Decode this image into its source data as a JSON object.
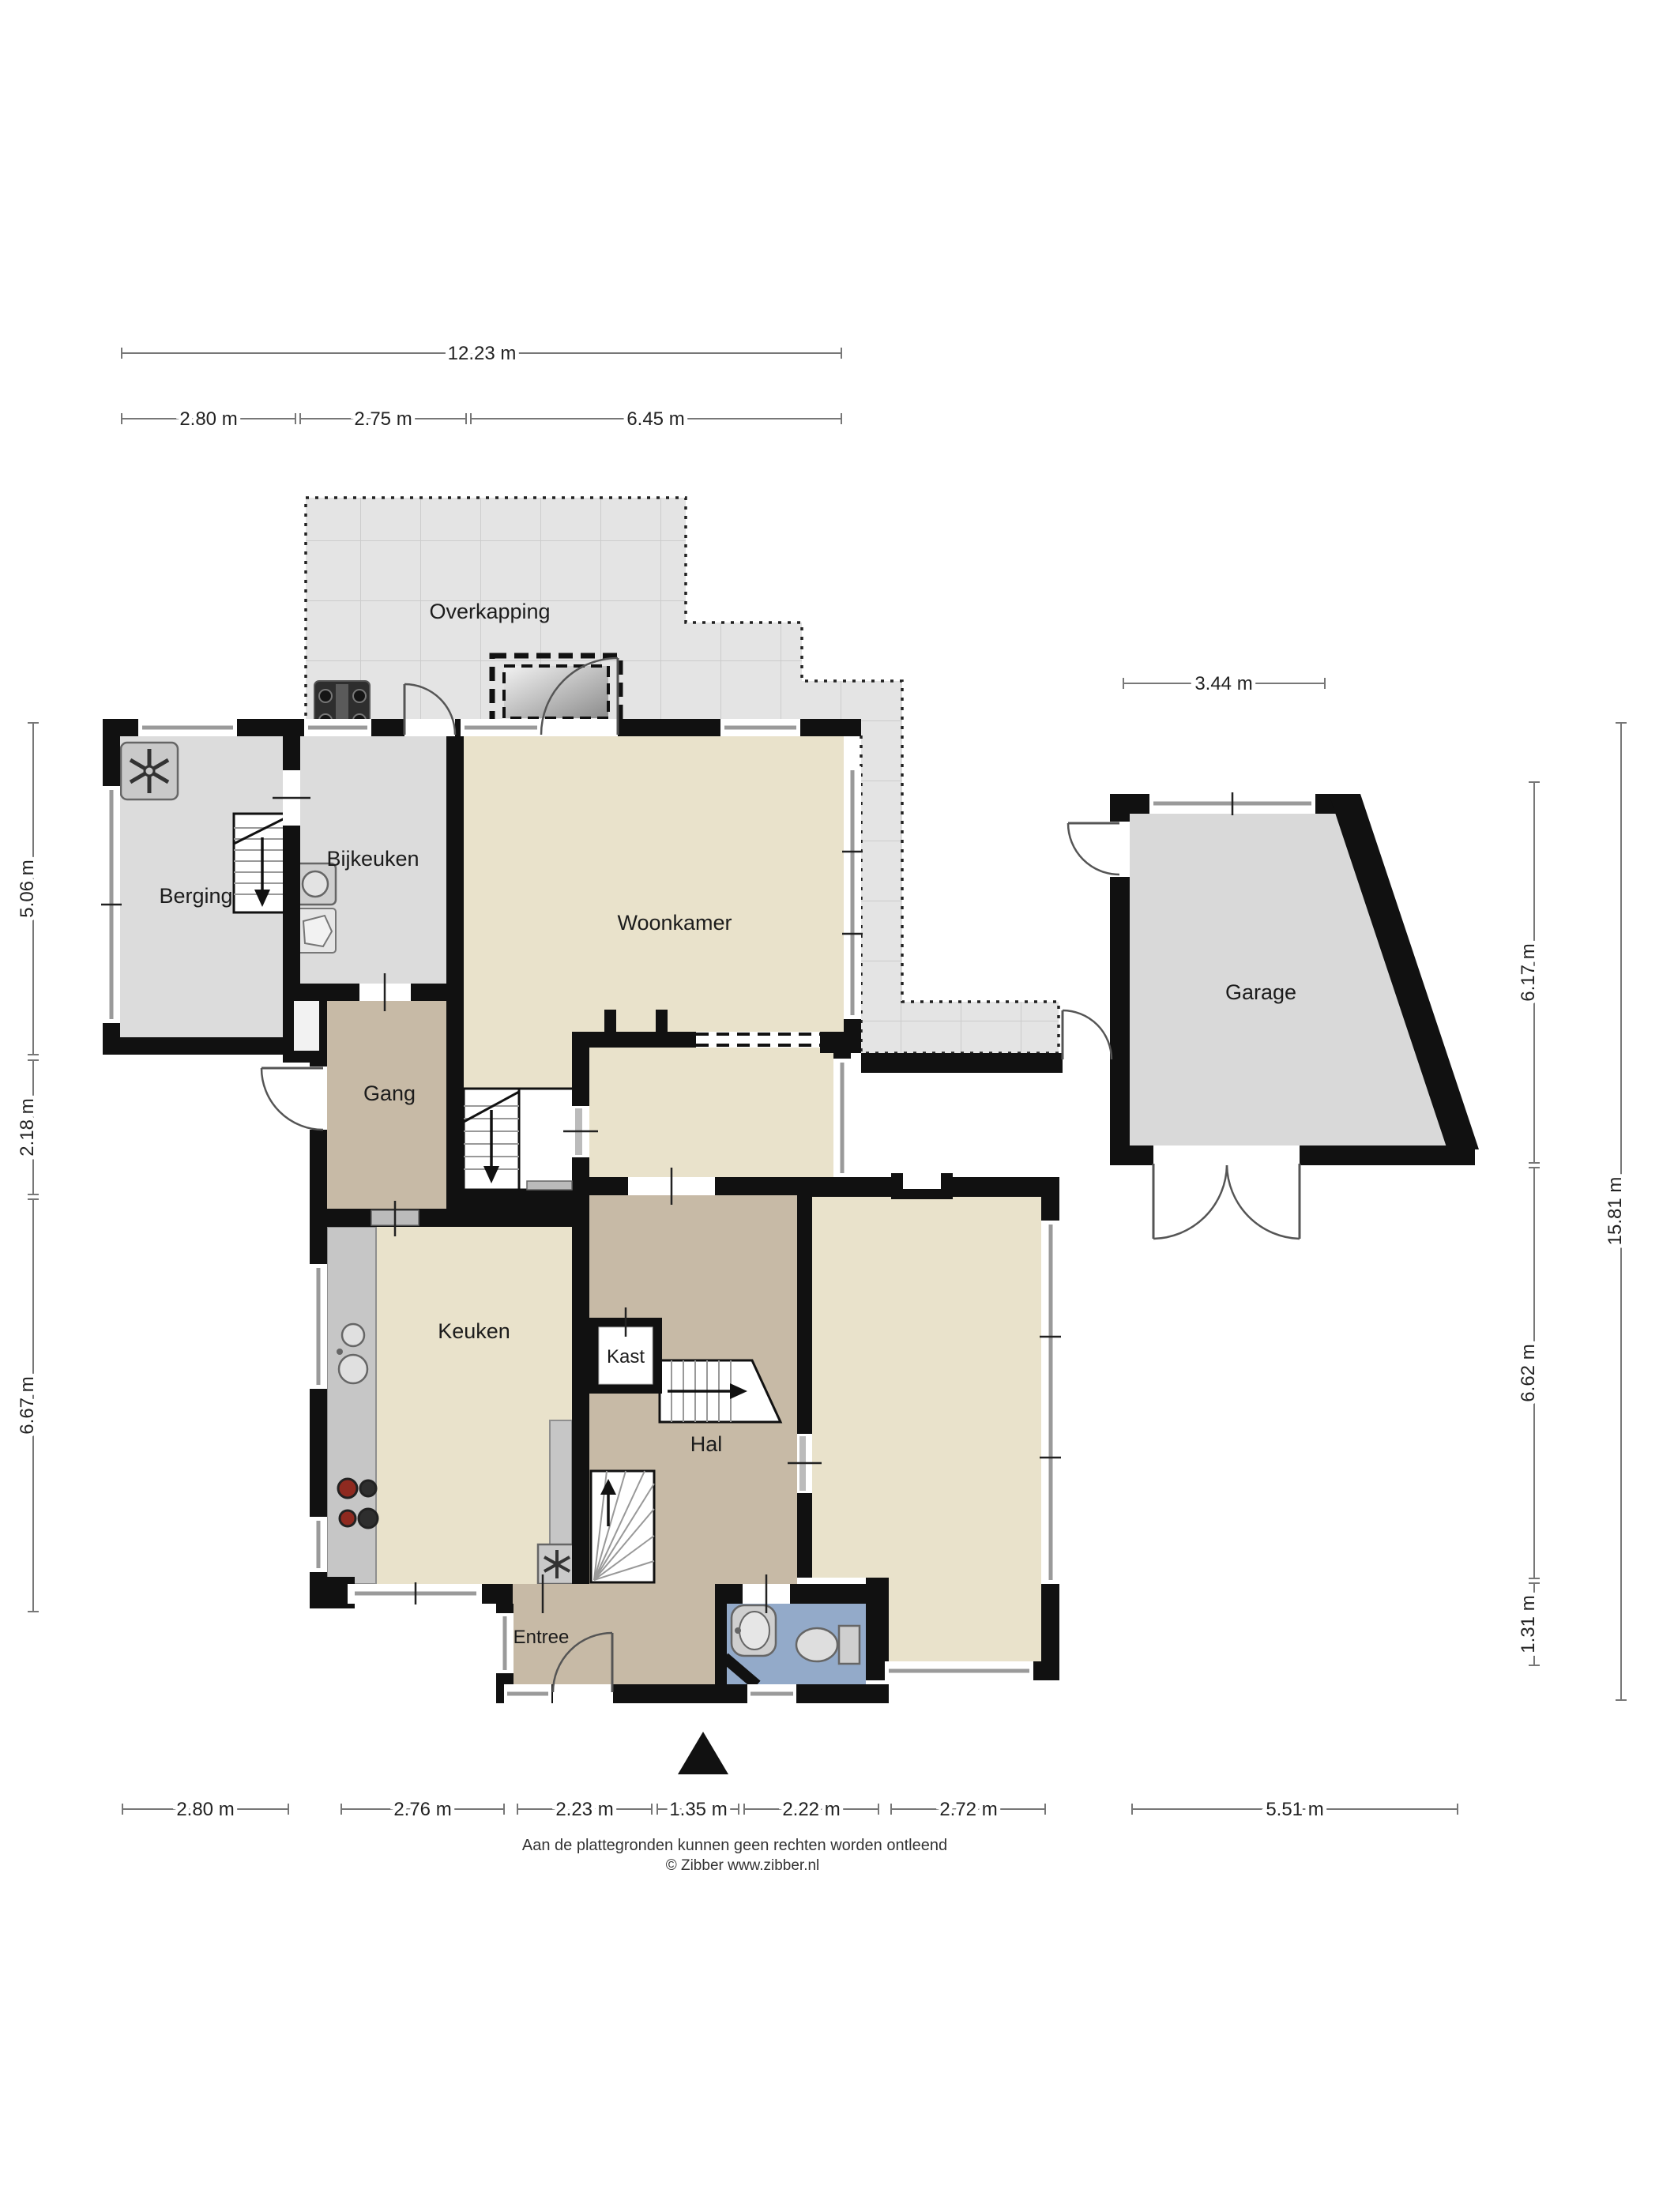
{
  "plan": {
    "title": "Begane grond plattegrond",
    "labels": {
      "overkapping": "Overkapping",
      "berging": "Berging",
      "bijkeuken": "Bijkeuken",
      "woonkamer": "Woonkamer",
      "gang": "Gang",
      "keuken": "Keuken",
      "kast": "Kast",
      "hal": "Hal",
      "entree": "Entree",
      "garage": "Garage"
    },
    "dimensions": {
      "top_total": "12.23 m",
      "top_a": "2.80 m",
      "top_b": "2.75 m",
      "top_c": "6.45 m",
      "garage_top": "3.44 m",
      "left_a": "5.06 m",
      "left_b": "2.18 m",
      "left_c": "6.67 m",
      "right_a": "6.17 m",
      "right_b": "6.62 m",
      "right_c": "1.31 m",
      "right_total": "15.81 m",
      "bottom_a": "2.80 m",
      "bottom_b": "2.76 m",
      "bottom_c": "2.23 m",
      "bottom_d": "1.35 m",
      "bottom_e": "2.22 m",
      "bottom_f": "2.72 m",
      "bottom_g": "5.51 m"
    },
    "footer": {
      "line1": "Aan de plattegronden kunnen geen rechten worden ontleend",
      "line2": "© Zibber www.zibber.nl"
    },
    "icons": {
      "north_arrow": "solid black triangle pointing up",
      "ventilation": "asterisk fan in grey box",
      "bbq_grill": "dark grill with four burners",
      "washer": "square with round door",
      "cooktop": "four burner circles",
      "toilet": "toilet with cistern",
      "wash_basin": "rounded basin",
      "stairs_down": "treads with down arrow",
      "stairs_up": "winder treads with up arrow",
      "skylight": "dashed double rectangle"
    },
    "colors": {
      "wall": "#111111",
      "floor_living": "#e9e2cb",
      "floor_hall": "#c7baa6",
      "floor_storage": "#dcdcdc",
      "floor_wc": "#93aac9",
      "terrace": "#e4e4e4",
      "garage_floor": "#d9d9d9",
      "counter": "#c6c6c6"
    }
  }
}
